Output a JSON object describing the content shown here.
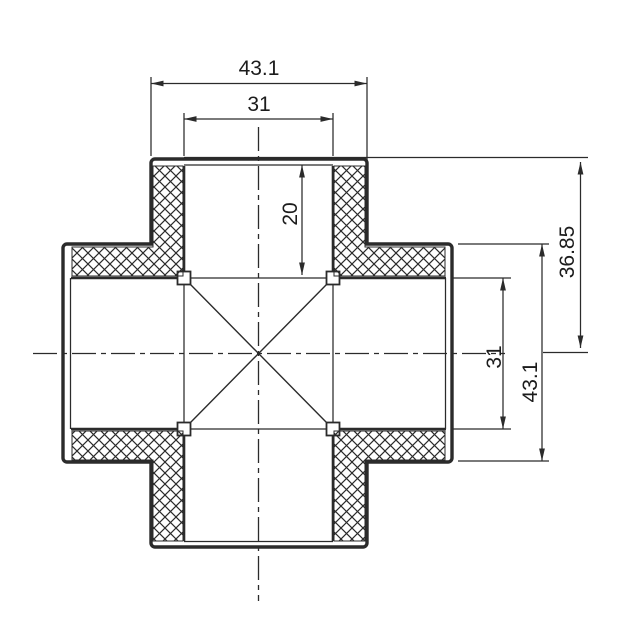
{
  "meta": {
    "type": "technical-drawing",
    "subject": "4-way cross pipe fitting cross-section"
  },
  "colors": {
    "background": "#ffffff",
    "line": "#2b2b2b",
    "text": "#1c1c1c"
  },
  "dimensions": {
    "top_outer_width": "43.1",
    "top_inner_width": "31",
    "top_socket_depth": "20",
    "face_to_center": "36.85",
    "side_inner_height": "31",
    "side_outer_height": "43.1"
  }
}
